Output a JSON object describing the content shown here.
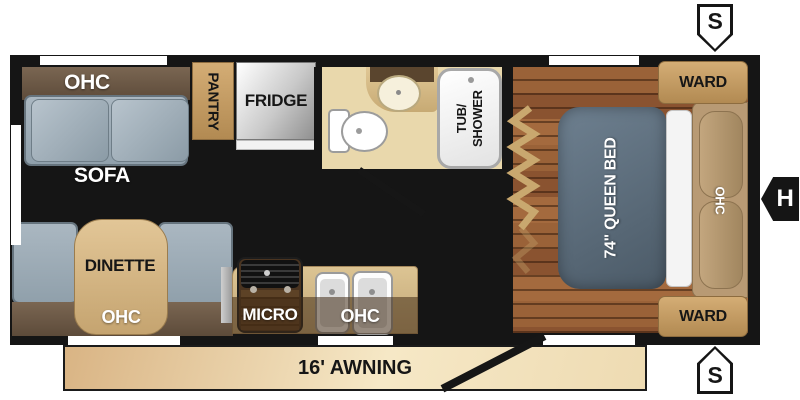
{
  "labels": {
    "sofa_ohc": "OHC",
    "sofa": "SOFA",
    "pantry": "PANTRY",
    "fridge": "FRIDGE",
    "tub_line1": "TUB/",
    "tub_line2": "SHOWER",
    "queen_bed": "74\" QUEEN BED",
    "bed_ohc": "OHC",
    "ward_top": "WARD",
    "ward_bottom": "WARD",
    "dinette": "DINETTE",
    "dinette_ohc": "OHC",
    "micro": "MICRO",
    "kitchen_ohc": "OHC",
    "awning": "16' AWNING",
    "marker_s_top": "S",
    "marker_s_bottom": "S",
    "marker_h": "H"
  },
  "colors": {
    "wall": "#151515",
    "floor_main": "#81502d",
    "floor_bedroom": "#92603a",
    "bathroom_floor": "#e9d8ac",
    "cabinet_tan": "#c8a268",
    "cabinet_brown": "#6a5645",
    "seat_gray": "#9fadb8",
    "bed_gray": "#5d6c7a",
    "counter_tan": "#cfb585",
    "awning_tan": "#f0dfb9"
  }
}
